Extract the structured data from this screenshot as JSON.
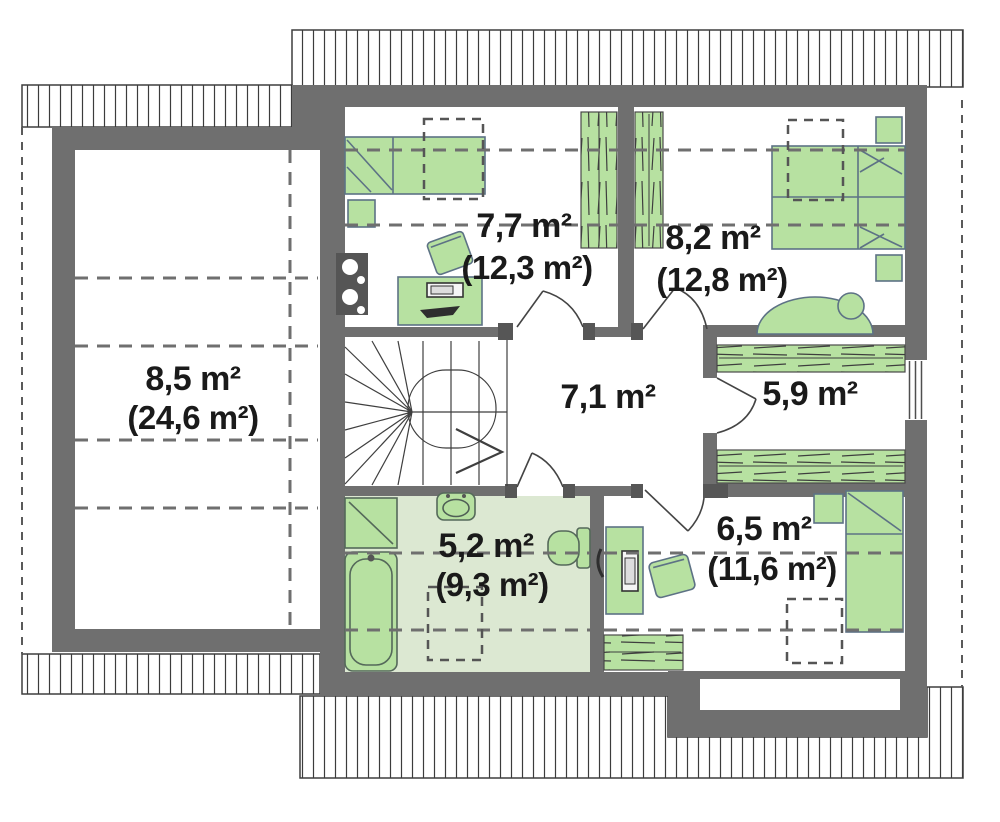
{
  "plan": {
    "type": "attic-floor-plan",
    "rooms": [
      {
        "name": "attic-space",
        "area": "8,5 m²",
        "area_gross": "(24,6 m²)"
      },
      {
        "name": "bedroom-top-left",
        "area": "7,7 m²",
        "area_gross": "(12,3 m²)"
      },
      {
        "name": "bedroom-top-right",
        "area": "8,2 m²",
        "area_gross": "(12,8 m²)"
      },
      {
        "name": "hall",
        "area": "7,1 m²",
        "area_gross": ""
      },
      {
        "name": "wardrobe-room",
        "area": "5,9 m²",
        "area_gross": ""
      },
      {
        "name": "bathroom",
        "area": "5,2 m²",
        "area_gross": "(9,3 m²)"
      },
      {
        "name": "bedroom-bottom-right",
        "area": "6,5 m²",
        "area_gross": "(11,6 m²)"
      }
    ],
    "colors": {
      "wall": "#6f6f6f",
      "furniture_fill": "#b7e1a1",
      "furniture_stroke": "#5d7285",
      "bathroom_floor": "#dce8d2",
      "dashed_line": "#6f6f6f",
      "hatch_line": "#3c3c3c",
      "text": "#1a1a1a"
    }
  }
}
